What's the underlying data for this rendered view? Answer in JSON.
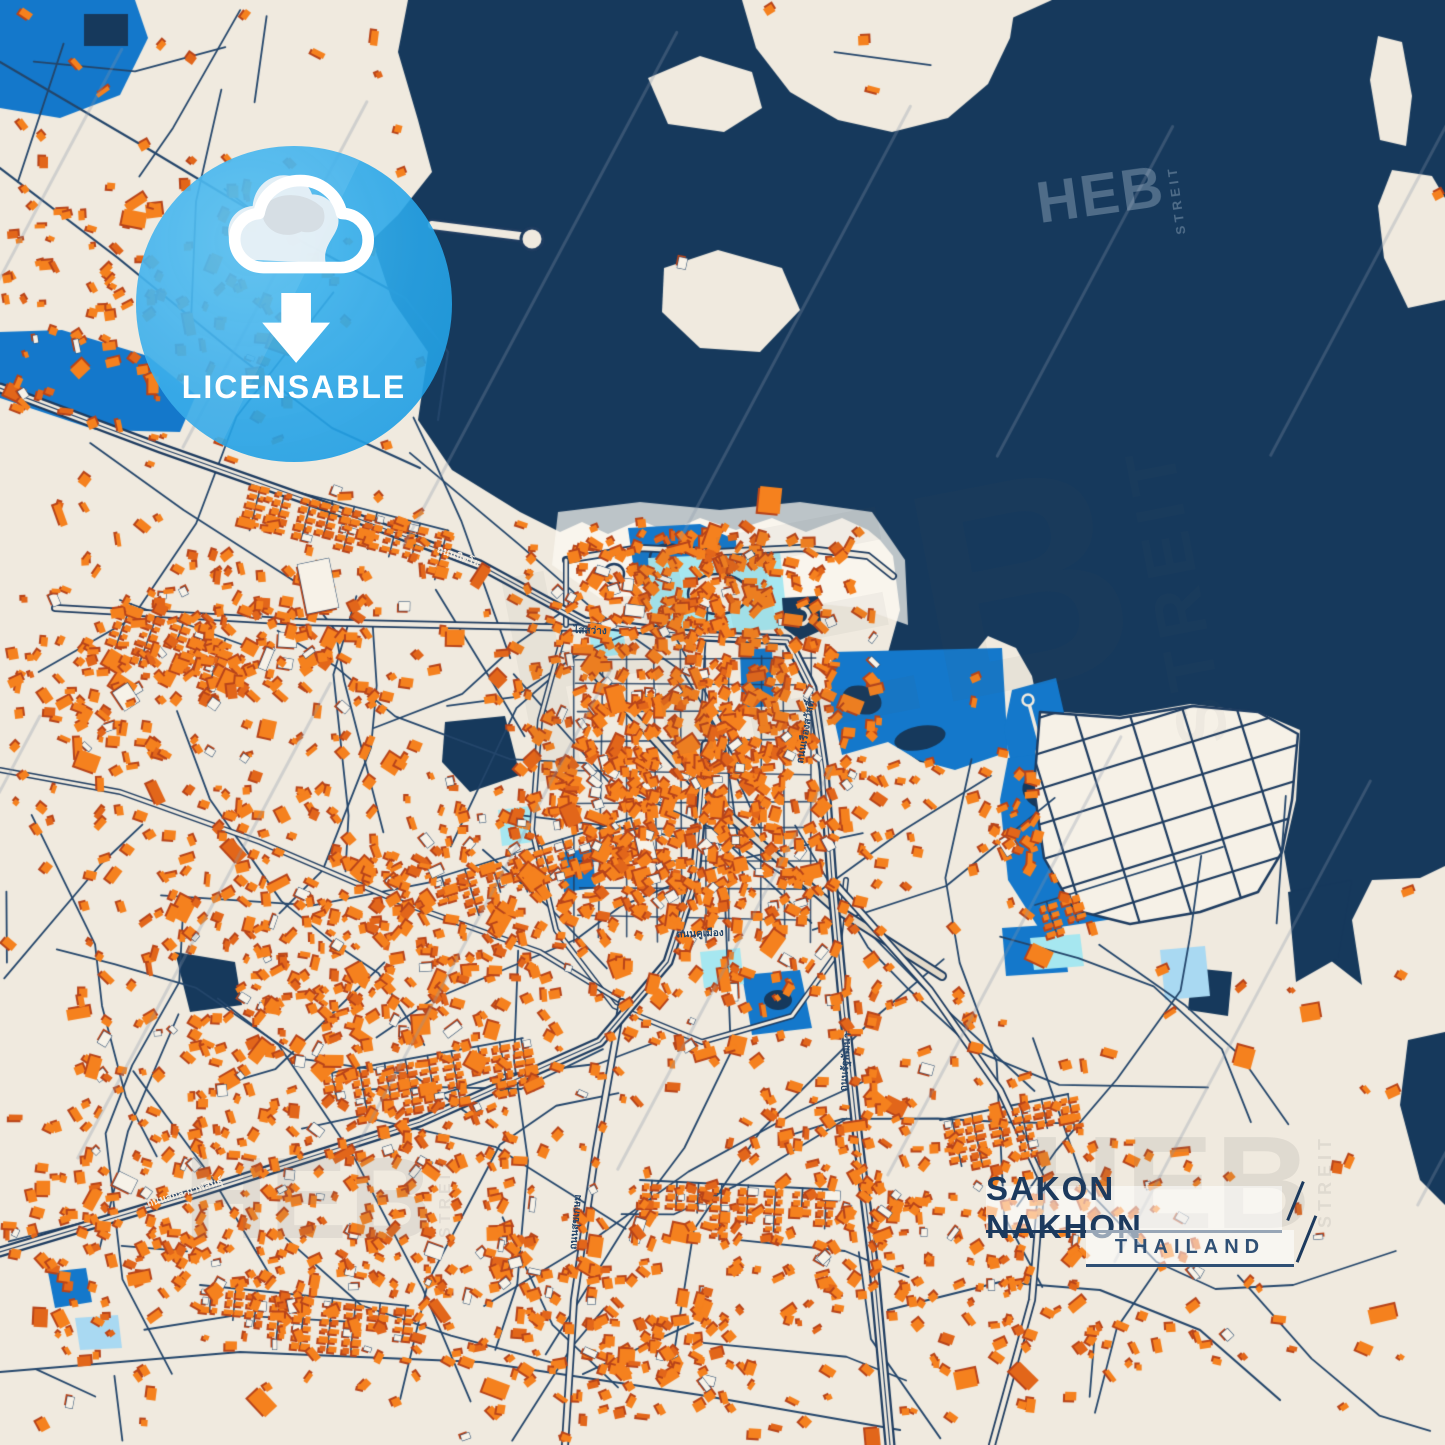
{
  "poster": {
    "title": "SAKON NAKHON",
    "subtitle": "THAILAND"
  },
  "badge": {
    "label": "LICENSABLE",
    "icon": "cloud-download-icon",
    "color": "#29A6E8"
  },
  "watermark": {
    "brand": "HEB",
    "brand_suffix": "STREIT"
  },
  "street_labels": [
    {
      "text": "ถนนนิตโย",
      "x": 458,
      "y": 557,
      "rot": 20,
      "tone": "cream"
    },
    {
      "text": "ถนนสกล-กาฬสินธุ์",
      "x": 185,
      "y": 1193,
      "rot": -17,
      "tone": "cream"
    },
    {
      "text": "ไสสว่าง",
      "x": 590,
      "y": 631,
      "rot": 2,
      "tone": "navy"
    },
    {
      "text": "ถนนสุขเกษม",
      "x": 576,
      "y": 1222,
      "rot": -85,
      "tone": "navy"
    },
    {
      "text": "ถนนคูเมือง",
      "x": 700,
      "y": 934,
      "rot": -2,
      "tone": "navy"
    },
    {
      "text": "ถนนรัฐพัฒนา",
      "x": 846,
      "y": 1062,
      "rot": -86,
      "tone": "navy"
    },
    {
      "text": "ถนนเรืองสวัสดิ์",
      "x": 806,
      "y": 732,
      "rot": -80,
      "tone": "navy"
    }
  ],
  "colors": {
    "land": "#F0EADF",
    "landBright": "#F6F1E7",
    "water": "#16395C",
    "building": "#F5811E",
    "buildingAlt": "#E2661A",
    "buildingShadow": "#B8441A",
    "buildingPale": "#F7F2E8",
    "road": "#1E3C60",
    "roadMinor": "#24466B",
    "roadFill": "#F0EADF",
    "paleRoad": "#E3DACA",
    "blue": "#1478CB",
    "cyan": "#A6E7F0",
    "pond": "#A9D9F2",
    "badge": "#29A6E8",
    "title": "#1C3A5E",
    "subtitle": "#2F5075",
    "labelNavy": "#24466B",
    "labelCream": "#F2ECE2",
    "diagonal": "rgba(135,150,170,0.30)"
  },
  "map": {
    "seed": 11,
    "width": 1445,
    "height": 1445
  }
}
